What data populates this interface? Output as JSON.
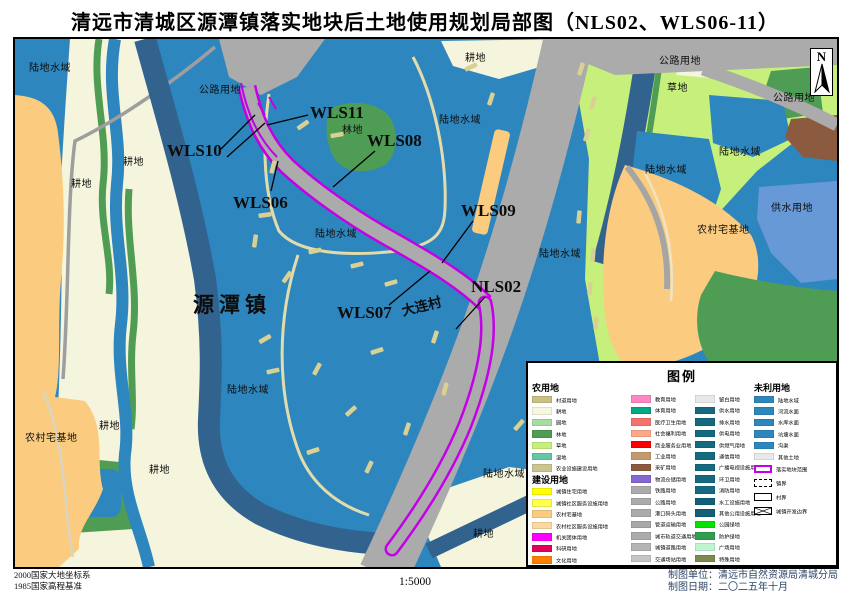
{
  "title": "清远市清城区源潭镇落实地块后土地使用规划局部图（NLS02、WLS06-11）",
  "north_arrow_label": "N",
  "footer": {
    "datum_line1": "2000国家大地坐标系",
    "datum_line2": "1985国家高程基准",
    "scale": "1:5000",
    "credit_line1": "制图单位：清远市自然资源局清城分局",
    "credit_line2": "制图日期：二〇二五年十月"
  },
  "colors": {
    "water_blue": "#2E86BE",
    "deep_water_band": "#31638E",
    "farmland_cream": "#F5F4DC",
    "homestead_orange": "#FBCC80",
    "forest_green": "#4F9D55",
    "grass_green": "#C6EF7C",
    "road_gray": "#ABABAB",
    "parcel_outline_purple": "#C400E6",
    "village_road_khaki": "#D9D193",
    "water_supply_blue": "#6699D6",
    "mining_brown": "#8C5A3F"
  },
  "map": {
    "region_labels": [
      {
        "text": "陆地水域",
        "x": 14,
        "y": 20
      },
      {
        "text": "耕地",
        "x": 56,
        "y": 136
      },
      {
        "text": "耕地",
        "x": 108,
        "y": 114
      },
      {
        "text": "公路用地",
        "x": 184,
        "y": 42
      },
      {
        "text": "林地",
        "x": 327,
        "y": 82
      },
      {
        "text": "陆地水域",
        "x": 300,
        "y": 186
      },
      {
        "text": "耕地",
        "x": 450,
        "y": 10
      },
      {
        "text": "陆地水域",
        "x": 424,
        "y": 72
      },
      {
        "text": "陆地水域",
        "x": 524,
        "y": 206
      },
      {
        "text": "公路用地",
        "x": 644,
        "y": 13
      },
      {
        "text": "草地",
        "x": 652,
        "y": 40
      },
      {
        "text": "公路用地",
        "x": 758,
        "y": 50
      },
      {
        "text": "陆地水域",
        "x": 630,
        "y": 122
      },
      {
        "text": "陆地水域",
        "x": 704,
        "y": 104
      },
      {
        "text": "农村宅基地",
        "x": 682,
        "y": 182
      },
      {
        "text": "供水用地",
        "x": 756,
        "y": 160
      },
      {
        "text": "陆地水域",
        "x": 212,
        "y": 342
      },
      {
        "text": "农村宅基地",
        "x": 10,
        "y": 390
      },
      {
        "text": "耕地",
        "x": 84,
        "y": 378
      },
      {
        "text": "耕地",
        "x": 134,
        "y": 422
      },
      {
        "text": "耕地",
        "x": 458,
        "y": 486
      },
      {
        "text": "陆地水域",
        "x": 468,
        "y": 426
      }
    ],
    "parcel_labels": [
      {
        "text": "WLS10",
        "x": 152,
        "y": 102
      },
      {
        "text": "WLS11",
        "x": 295,
        "y": 64
      },
      {
        "text": "WLS06",
        "x": 218,
        "y": 154
      },
      {
        "text": "WLS08",
        "x": 352,
        "y": 92
      },
      {
        "text": "WLS09",
        "x": 446,
        "y": 162
      },
      {
        "text": "WLS07",
        "x": 322,
        "y": 264
      },
      {
        "text": "NLS02",
        "x": 456,
        "y": 238
      }
    ],
    "place_labels": [
      {
        "text": "源潭镇",
        "x": 178,
        "y": 250,
        "kind": "town"
      },
      {
        "text": "大连村",
        "x": 386,
        "y": 256,
        "kind": "village"
      }
    ]
  },
  "legend": {
    "title": "图例",
    "columns": [
      {
        "x": 4,
        "spacer": false,
        "entries": [
          {
            "type": "header",
            "text": "农用地"
          },
          {
            "type": "item",
            "label": "村道用地",
            "color": "#C9C083"
          },
          {
            "type": "item",
            "label": "耕地",
            "color": "#F7F6DF"
          },
          {
            "type": "item",
            "label": "园地",
            "color": "#A8DCA0"
          },
          {
            "type": "item",
            "label": "林地",
            "color": "#4F9D55"
          },
          {
            "type": "item",
            "label": "草地",
            "color": "#C6EF7C"
          },
          {
            "type": "item",
            "label": "湿地",
            "color": "#63C6A5"
          },
          {
            "type": "item",
            "label": "农业设施建设用地",
            "color": "#CDC58F"
          },
          {
            "type": "header",
            "text": "建设用地"
          },
          {
            "type": "item",
            "label": "城镇住宅用地",
            "color": "#FFFF00"
          },
          {
            "type": "item",
            "label": "城镇社区服务设施用地",
            "color": "#FFFF4C"
          },
          {
            "type": "item",
            "label": "农村宅基地",
            "color": "#FBCC80"
          },
          {
            "type": "item",
            "label": "农村社区服务设施用地",
            "color": "#FCD9A0"
          },
          {
            "type": "item",
            "label": "机关团体用地",
            "color": "#FF00FF"
          },
          {
            "type": "item",
            "label": "科研用地",
            "color": "#E50060"
          },
          {
            "type": "item",
            "label": "文化用地",
            "color": "#FF8000"
          }
        ]
      },
      {
        "x": 103,
        "spacer": true,
        "entries": [
          {
            "type": "item",
            "label": "教育用地",
            "color": "#FF87C3"
          },
          {
            "type": "item",
            "label": "体育用地",
            "color": "#00A884"
          },
          {
            "type": "item",
            "label": "医疗卫生用地",
            "color": "#F4736E"
          },
          {
            "type": "item",
            "label": "社会福利用地",
            "color": "#FFA888"
          },
          {
            "type": "item",
            "label": "商业服务业用地",
            "color": "#FF0000"
          },
          {
            "type": "item",
            "label": "工业用地",
            "color": "#C49A6C"
          },
          {
            "type": "item",
            "label": "采矿用地",
            "color": "#8C5A3F"
          },
          {
            "type": "item",
            "label": "物流仓储用地",
            "color": "#8567D2"
          },
          {
            "type": "item",
            "label": "铁路用地",
            "color": "#ABABAB"
          },
          {
            "type": "item",
            "label": "公路用地",
            "color": "#ABABAB"
          },
          {
            "type": "item",
            "label": "港口码头用地",
            "color": "#ABABAB"
          },
          {
            "type": "item",
            "label": "管道运输用地",
            "color": "#A8A8A8"
          },
          {
            "type": "item",
            "label": "城市轨道交通用地",
            "color": "#ABABAB"
          },
          {
            "type": "item",
            "label": "城镇道路用地",
            "color": "#B5B5B5"
          },
          {
            "type": "item",
            "label": "交通场站用地",
            "color": "#C6C6C6"
          }
        ]
      },
      {
        "x": 167,
        "spacer": true,
        "entries": [
          {
            "type": "item",
            "label": "留白用地",
            "color": "#E9E9E9"
          },
          {
            "type": "item",
            "label": "供水用地",
            "color": "#156A80"
          },
          {
            "type": "item",
            "label": "排水用地",
            "color": "#156A80"
          },
          {
            "type": "item",
            "label": "供电用地",
            "color": "#156A80"
          },
          {
            "type": "item",
            "label": "供燃气用地",
            "color": "#156A80"
          },
          {
            "type": "item",
            "label": "通信用地",
            "color": "#156A80"
          },
          {
            "type": "item",
            "label": "广播电视设施用地",
            "color": "#156A80"
          },
          {
            "type": "item",
            "label": "环卫用地",
            "color": "#156A80"
          },
          {
            "type": "item",
            "label": "消防用地",
            "color": "#156A80"
          },
          {
            "type": "item",
            "label": "水工设施用地",
            "color": "#10607A"
          },
          {
            "type": "item",
            "label": "其他公用设施用地",
            "color": "#10607A"
          },
          {
            "type": "item",
            "label": "公园绿地",
            "color": "#00E400"
          },
          {
            "type": "item",
            "label": "防护绿地",
            "color": "#2F9E4F"
          },
          {
            "type": "item",
            "label": "广场用地",
            "color": "#BDF6CE"
          },
          {
            "type": "item",
            "label": "特殊用地",
            "color": "#7E8A4D"
          }
        ]
      },
      {
        "x": 226,
        "spacer": false,
        "entries": [
          {
            "type": "header",
            "text": "未利用地"
          },
          {
            "type": "item",
            "label": "陆地水域",
            "color": "#2E86BE"
          },
          {
            "type": "item",
            "label": "河流水面",
            "color": "#2E86BE"
          },
          {
            "type": "item",
            "label": "水库水面",
            "color": "#2E86BE"
          },
          {
            "type": "item",
            "label": "坑塘水面",
            "color": "#2E86BE"
          },
          {
            "type": "item",
            "label": "沟渠",
            "color": "#2E86BE"
          },
          {
            "type": "item",
            "label": "其他土地",
            "color": "#E9E9E9"
          },
          {
            "type": "boundary",
            "kind": "parcel",
            "label": "落实地块范围"
          },
          {
            "type": "boundary",
            "kind": "town-dashed",
            "label": "镇界"
          },
          {
            "type": "boundary",
            "kind": "village-solid",
            "label": "村界"
          },
          {
            "type": "boundary",
            "kind": "development-cross",
            "label": "城镇开发边界"
          }
        ]
      }
    ]
  }
}
